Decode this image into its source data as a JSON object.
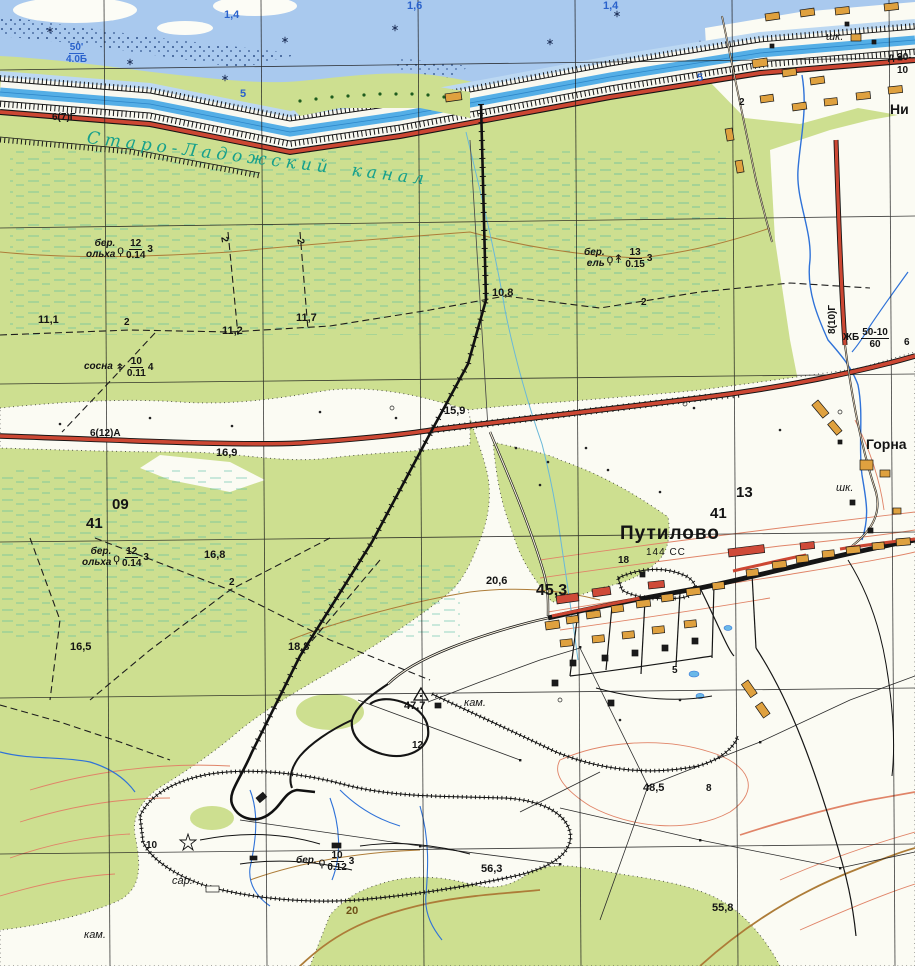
{
  "map": {
    "region": "topographic-sheet",
    "colors": {
      "forest_green": "#cddf90",
      "water_blue": "#a9c9ee",
      "canal_blue": "#54aee6",
      "road_red": "#cc4733",
      "building_orange": "#dfa13f",
      "building_red": "#cf4a38",
      "contour_brown": "#ad7c38",
      "contour_salmon": "#e08468",
      "hydro_label_blue": "#2a62cc",
      "canal_name_teal": "#16a08c",
      "grid_black": "#1a1a1a",
      "swamp_teal": "#4fb8a0"
    },
    "labels": [
      {
        "id": "canal-name",
        "cls": "canal-name",
        "x": 88,
        "y": 130,
        "rot": 7,
        "t": "Старо-Ладожский канал"
      },
      {
        "id": "depth-1-6",
        "cls": "hydro",
        "x": 407,
        "y": 1,
        "t": "1,6"
      },
      {
        "id": "depth-1-4-a",
        "cls": "hydro",
        "x": 224,
        "y": 10,
        "t": "1,4"
      },
      {
        "id": "depth-1-4-b",
        "cls": "hydro",
        "x": 603,
        "y": 1,
        "t": "1,4"
      },
      {
        "id": "canal-depth-5-a",
        "cls": "hydro",
        "x": 240,
        "y": 89,
        "t": "5"
      },
      {
        "id": "canal-depth-5-b",
        "cls": "hydro",
        "x": 697,
        "y": 73,
        "t": "5"
      },
      {
        "id": "canal-spec",
        "cls": "frac plain hydro",
        "x": 66,
        "y": 42,
        "type": "frac",
        "pre": [],
        "num": "50'",
        "den": "4.0Б"
      },
      {
        "id": "road-spec-left",
        "cls": "road-label",
        "x": 52,
        "y": 113,
        "t": "6(7)Г"
      },
      {
        "id": "road-spec-main",
        "cls": "road-label",
        "x": 90,
        "y": 429,
        "t": "6(12)А"
      },
      {
        "id": "road-spec-right",
        "cls": "road-label",
        "x": 828,
        "y": 334,
        "rot": -90,
        "t": "8(10)Г"
      },
      {
        "id": "road-width-6",
        "cls": "road-label",
        "x": 904,
        "y": 338,
        "t": "6"
      },
      {
        "id": "bridge-spec-zhb",
        "cls": "frac plain",
        "x": 843,
        "y": 327,
        "type": "frac",
        "pre": [
          "ЖБ"
        ],
        "num": "50-10",
        "den": "60"
      },
      {
        "id": "bridge-spec-d20",
        "cls": "road-label",
        "x": 888,
        "y": 53,
        "t": "д 20-"
      },
      {
        "id": "bridge-spec-d20-b",
        "cls": "road-label",
        "x": 897,
        "y": 66,
        "t": "10"
      },
      {
        "id": "settlement-putilovo",
        "cls": "settlement-lg",
        "x": 620,
        "y": 524,
        "t": "Путилово"
      },
      {
        "id": "putilovo-population",
        "cls": "note-upright",
        "x": 646,
        "y": 548,
        "t": "144 СС"
      },
      {
        "id": "settlement-gornaya",
        "cls": "settlement-md",
        "x": 866,
        "y": 437,
        "t": "Горна"
      },
      {
        "id": "settlement-ni",
        "cls": "settlement-md",
        "x": 890,
        "y": 102,
        "t": "Ни"
      },
      {
        "id": "school-top",
        "cls": "note",
        "x": 826,
        "y": 32,
        "t": "шк."
      },
      {
        "id": "school-gornaya",
        "cls": "note",
        "x": 836,
        "y": 483,
        "t": "шк."
      },
      {
        "id": "barn-note",
        "cls": "note",
        "x": 172,
        "y": 876,
        "t": "сар."
      },
      {
        "id": "quarry-note-sw",
        "cls": "note",
        "x": 84,
        "y": 930,
        "t": "кам."
      },
      {
        "id": "quarry-note-c",
        "cls": "note",
        "x": 464,
        "y": 698,
        "t": "кам."
      },
      {
        "id": "elev-16-9",
        "cls": "elev",
        "x": 216,
        "y": 448,
        "t": "16,9"
      },
      {
        "id": "elev-15-9",
        "cls": "elev",
        "x": 444,
        "y": 406,
        "t": "15,9"
      },
      {
        "id": "elev-10-8",
        "cls": "elev",
        "x": 492,
        "y": 288,
        "t": "10,8"
      },
      {
        "id": "elev-11-1",
        "cls": "elev",
        "x": 38,
        "y": 315,
        "t": "11,1"
      },
      {
        "id": "elev-11-2",
        "cls": "elev",
        "x": 222,
        "y": 326,
        "t": "11,2"
      },
      {
        "id": "elev-11-7",
        "cls": "elev",
        "x": 296,
        "y": 313,
        "t": "11,7"
      },
      {
        "id": "elev-16-8",
        "cls": "elev",
        "x": 204,
        "y": 550,
        "t": "16,8"
      },
      {
        "id": "elev-16-5",
        "cls": "elev",
        "x": 70,
        "y": 642,
        "t": "16,5"
      },
      {
        "id": "elev-18-8",
        "cls": "elev",
        "x": 288,
        "y": 642,
        "t": "18,8"
      },
      {
        "id": "elev-20-6",
        "cls": "elev",
        "x": 486,
        "y": 576,
        "t": "20,6"
      },
      {
        "id": "elev-45-3",
        "cls": "elev-lg",
        "x": 536,
        "y": 583,
        "t": "45,3"
      },
      {
        "id": "elev-47-7",
        "cls": "elev",
        "x": 404,
        "y": 701,
        "t": "47,7"
      },
      {
        "id": "elev-48-5",
        "cls": "elev",
        "x": 643,
        "y": 783,
        "t": "48,5"
      },
      {
        "id": "elev-56-3",
        "cls": "elev",
        "x": 481,
        "y": 864,
        "t": "56,3"
      },
      {
        "id": "elev-55-8",
        "cls": "elev",
        "x": 712,
        "y": 903,
        "t": "55,8"
      },
      {
        "id": "contour-20",
        "cls": "contour-num",
        "x": 346,
        "y": 906,
        "t": "20"
      },
      {
        "id": "quarry-depth-12",
        "cls": "elev-sm",
        "x": 412,
        "y": 741,
        "t": "12"
      },
      {
        "id": "mark-8",
        "cls": "elev-sm",
        "x": 706,
        "y": 784,
        "t": "8"
      },
      {
        "id": "mark-5",
        "cls": "elev-sm",
        "x": 672,
        "y": 666,
        "t": "5"
      },
      {
        "id": "mark-18",
        "cls": "elev-sm",
        "x": 618,
        "y": 556,
        "t": "18"
      },
      {
        "id": "quarry-depth-10",
        "cls": "elev-sm",
        "x": 146,
        "y": 841,
        "t": "10"
      },
      {
        "id": "grid-09",
        "cls": "grid-num",
        "x": 112,
        "y": 497,
        "t": "09"
      },
      {
        "id": "grid-41-w",
        "cls": "grid-num",
        "x": 86,
        "y": 516,
        "t": "41"
      },
      {
        "id": "grid-13",
        "cls": "grid-num",
        "x": 736,
        "y": 485,
        "t": "13"
      },
      {
        "id": "grid-41-e",
        "cls": "grid-num",
        "x": 710,
        "y": 506,
        "t": "41"
      },
      {
        "id": "ditch-2-a",
        "cls": "elev-sm",
        "x": 124,
        "y": 318,
        "t": "2"
      },
      {
        "id": "ditch-2-b",
        "cls": "elev-sm",
        "x": 228,
        "y": 236,
        "rot": 80,
        "t": "2"
      },
      {
        "id": "ditch-2-c",
        "cls": "elev-sm",
        "x": 304,
        "y": 238,
        "rot": 80,
        "t": "2"
      },
      {
        "id": "ditch-2-d",
        "cls": "elev-sm",
        "x": 641,
        "y": 298,
        "t": "2"
      },
      {
        "id": "ditch-2-e",
        "cls": "elev-sm",
        "x": 229,
        "y": 578,
        "t": "2"
      },
      {
        "id": "ditch-2-f",
        "cls": "elev-sm",
        "x": 739,
        "y": 98,
        "t": "2"
      },
      {
        "id": "forest-birch-alder-n",
        "cls": "frac",
        "x": 86,
        "y": 238,
        "type": "frac",
        "pre": [
          "бер.",
          "ольха"
        ],
        "sym": "d",
        "num": "12",
        "den": "0.14",
        "suf": "3"
      },
      {
        "id": "forest-pine",
        "cls": "frac",
        "x": 84,
        "y": 356,
        "type": "frac",
        "pre": [
          "сосна"
        ],
        "sym": "c",
        "num": "10",
        "den": "0.11",
        "suf": "4"
      },
      {
        "id": "forest-birch-spruce",
        "cls": "frac",
        "x": 584,
        "y": 247,
        "type": "frac",
        "pre": [
          "бер.",
          "ель"
        ],
        "sym": "dc",
        "num": "13",
        "den": "0.15",
        "suf": "3"
      },
      {
        "id": "forest-birch-alder-s",
        "cls": "frac",
        "x": 82,
        "y": 546,
        "type": "frac",
        "pre": [
          "бер.",
          "ольха"
        ],
        "sym": "d",
        "num": "12",
        "den": "0.14",
        "suf": "3"
      },
      {
        "id": "forest-birch-sw",
        "cls": "frac",
        "x": 296,
        "y": 850,
        "type": "frac",
        "pre": [
          "бер."
        ],
        "sym": "d",
        "num": "10",
        "den": "0.12",
        "suf": "3"
      }
    ],
    "tree_symbols": {
      "deciduous": "ϙ",
      "conifer": "↟"
    }
  }
}
